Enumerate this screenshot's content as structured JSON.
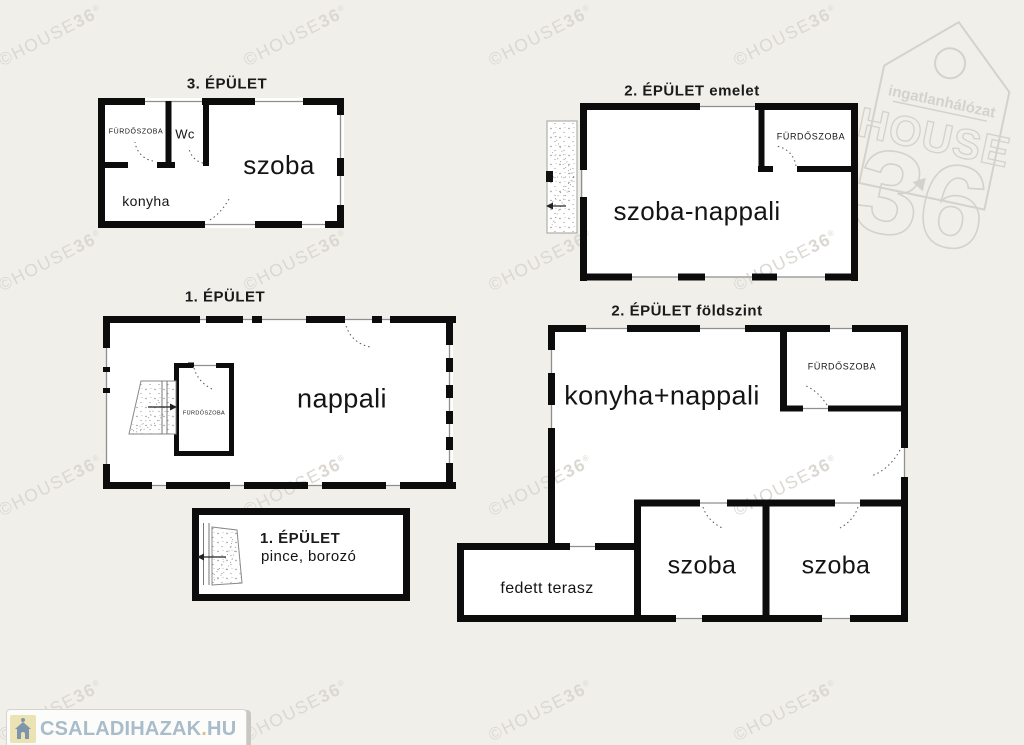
{
  "page": {
    "background": "#f0efe9"
  },
  "colors": {
    "wall": "#0c0c0c",
    "interior": "#ffffff",
    "watermark_gray": "#dbd8d2",
    "logo_outline_gray": "#d4d2cc",
    "footer_text_blue": "#a8bcca",
    "footer_accent_tan": "#d9c28a",
    "footer_icon_bg": "#ece3b4"
  },
  "watermark": {
    "copyright": "©",
    "brand": "HOUSE",
    "number": "36",
    "registered": "®"
  },
  "brand_logo": {
    "network_label": "ingatlanhálózat",
    "brand": "HOUSE",
    "number": "36"
  },
  "footer_logo": {
    "site_main": "CSALADIHAZAK",
    "site_dot": ".",
    "site_tld": "HU"
  },
  "buildings": {
    "b3": {
      "title": "3. ÉPÜLET",
      "rooms": {
        "bathroom": "FÜRDŐSZOBA",
        "wc": "Wc",
        "room": "szoba",
        "kitchen": "konyha"
      }
    },
    "b2_upper": {
      "title": "2. ÉPÜLET emelet",
      "rooms": {
        "bathroom": "FÜRDŐSZOBA",
        "living": "szoba-nappali"
      }
    },
    "b1": {
      "title": "1. ÉPÜLET",
      "rooms": {
        "bathroom": "FÜRDŐSZOBA",
        "living": "nappali"
      }
    },
    "b2_ground": {
      "title": "2. ÉPÜLET földszint",
      "rooms": {
        "bathroom": "FÜRDŐSZOBA",
        "kitchen_living": "konyha+nappali",
        "room1": "szoba",
        "room2": "szoba",
        "terrace": "fedett terasz"
      }
    },
    "b1_cellar": {
      "title": "1. ÉPÜLET",
      "subtitle": "pince, borozó"
    }
  }
}
